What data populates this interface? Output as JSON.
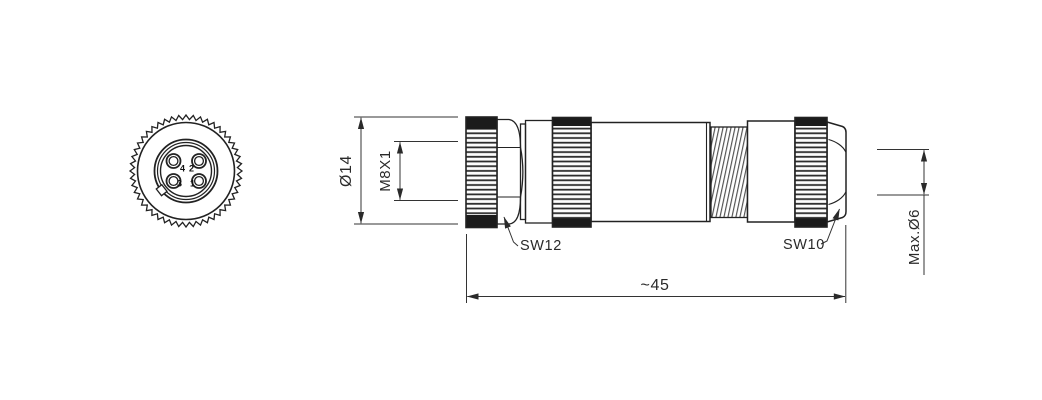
{
  "front_view": {
    "pins": {
      "top_left": "4",
      "top_right": "2",
      "bottom_left": "3",
      "bottom_right": "1"
    }
  },
  "dimensions": {
    "outer_diameter": "Ø14",
    "thread_spec": "M8X1",
    "front_wrench_size": "SW12",
    "back_wrench_size": "SW10",
    "overall_length": "~45",
    "max_cable_diameter": "Max.Ø6"
  },
  "colors": {
    "line": "#222222",
    "dimension_line": "#333333",
    "knurl_dark": "#1b1b1b",
    "background": "#ffffff"
  }
}
